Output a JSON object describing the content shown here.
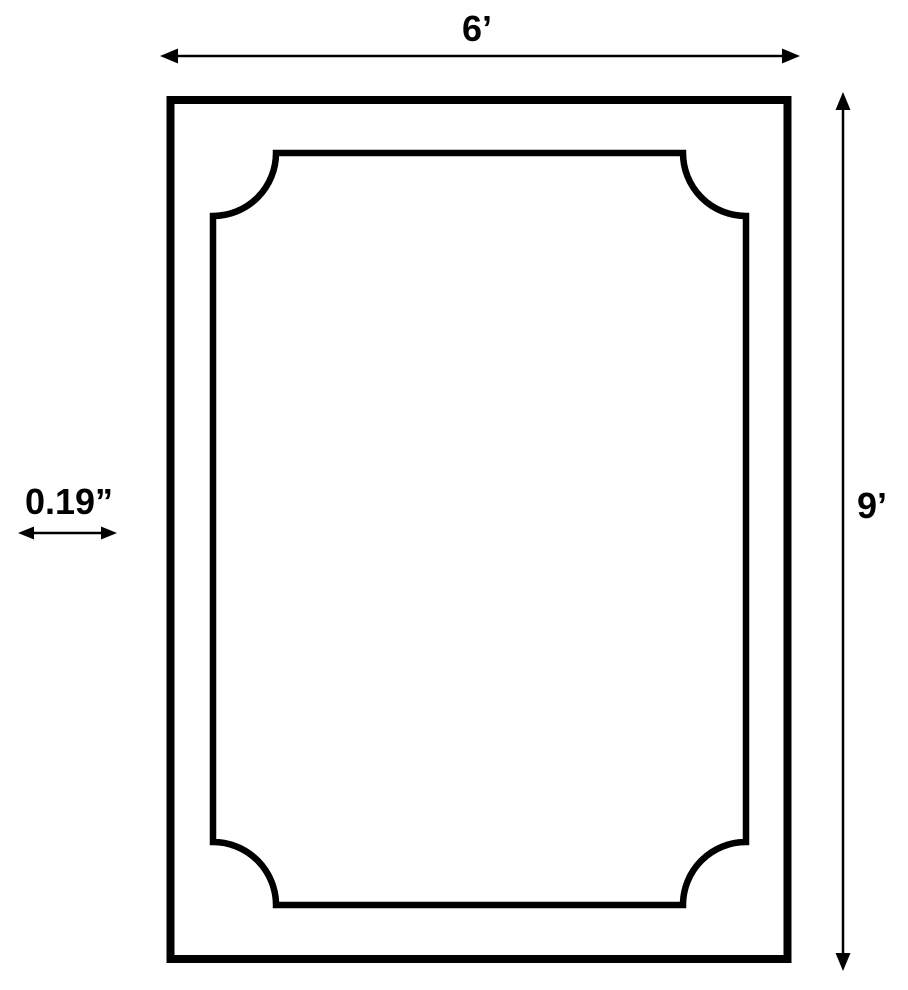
{
  "diagram": {
    "type": "dimension-diagram",
    "subject": "rectangle with inner scalloped-corner border (6 ft by 9 ft, 0.19 in detail)",
    "labels": {
      "width": "6’",
      "height": "9’",
      "thickness": "0.19”"
    },
    "colors": {
      "line": "#000000",
      "background": "#ffffff"
    }
  }
}
